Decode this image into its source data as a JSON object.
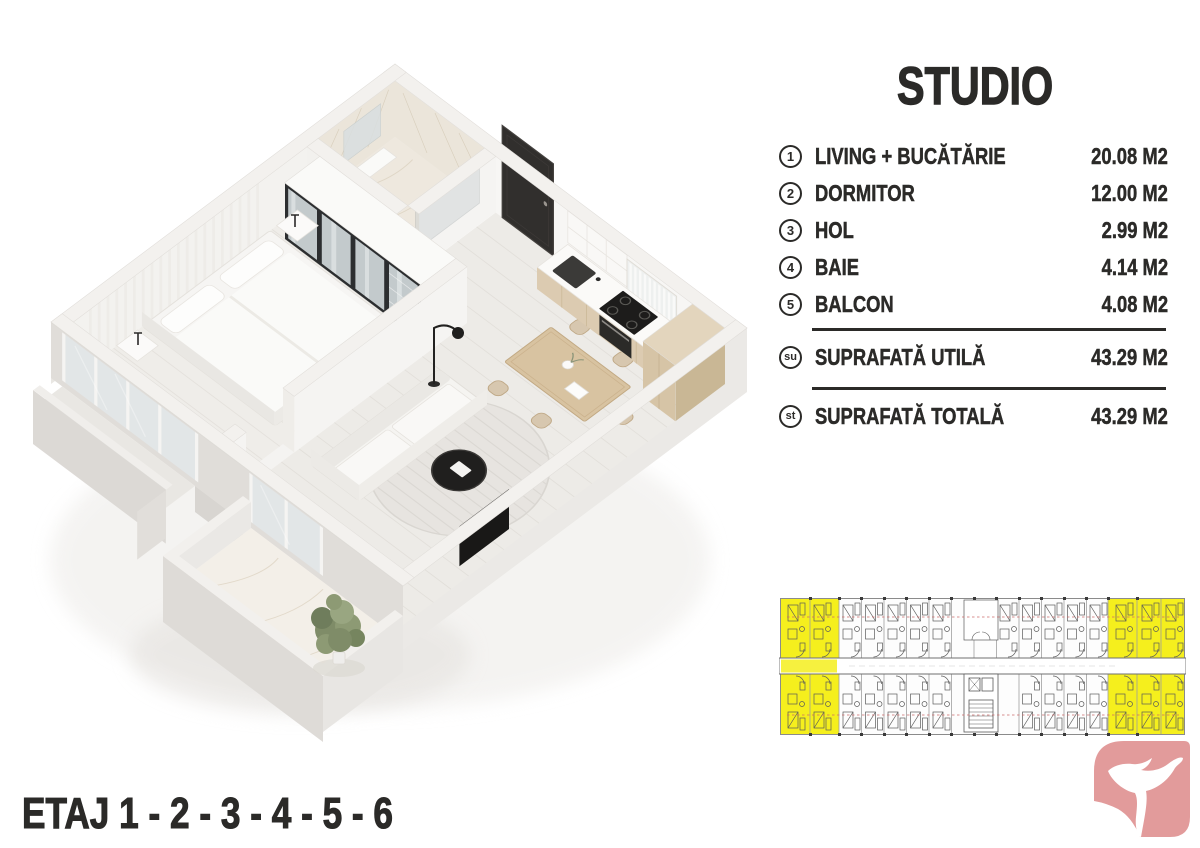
{
  "title": "STUDIO",
  "rooms": [
    {
      "num": "1",
      "label": "LIVING + BUCĂTĂRIE",
      "area": "20.08 M2"
    },
    {
      "num": "2",
      "label": "DORMITOR",
      "area": "12.00 M2"
    },
    {
      "num": "3",
      "label": "HOL",
      "area": "2.99 M2"
    },
    {
      "num": "4",
      "label": "BAIE",
      "area": "4.14 M2"
    },
    {
      "num": "5",
      "label": "BALCON",
      "area": "4.08 M2"
    }
  ],
  "totals": [
    {
      "code": "su",
      "label": "SUPRAFATĂ UTILĂ",
      "area": "43.29 M2"
    },
    {
      "code": "st",
      "label": "SUPRAFATĂ TOTALĂ",
      "area": "43.29 M2"
    }
  ],
  "floors_label": "ETAJ 1 - 2 - 3 - 4 - 5 - 6",
  "colors": {
    "text": "#2b2a28",
    "highlight_yellow": "#f5ef1d",
    "logo_pink": "#e29b9b",
    "plan_wall": "#f3f1ee",
    "plan_wood": "#d8c3a1"
  },
  "icons": {
    "logo": "dove-logo-icon",
    "unit_plan": "building-level-plan"
  }
}
